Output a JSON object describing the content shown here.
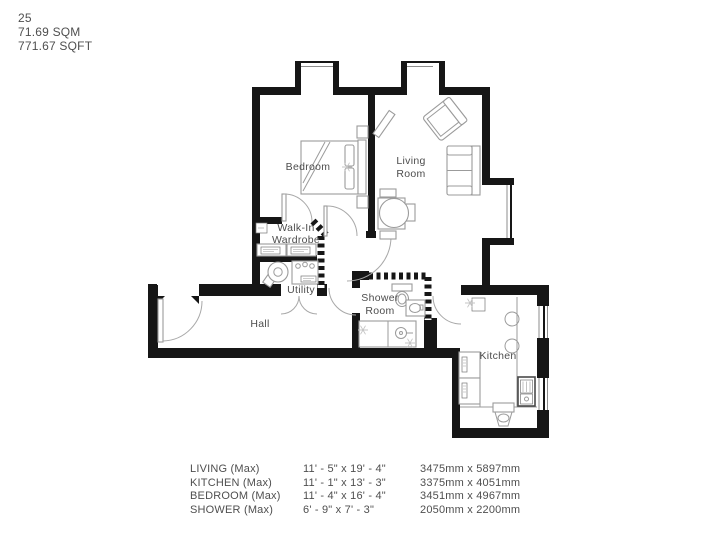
{
  "header": {
    "unit_number": "25",
    "area_sqm": "71.69 SQM",
    "area_sqft": "771.67 SQFT"
  },
  "floorplan": {
    "rooms": {
      "bedroom": "Bedroom",
      "living_line1": "Living",
      "living_line2": "Room",
      "wardrobe_line1": "Walk-In",
      "wardrobe_line2": "Wardrobe",
      "utility": "Utility",
      "hall": "Hall",
      "shower_line1": "Shower",
      "shower_line2": "Room",
      "kitchen": "Kitchen"
    }
  },
  "dimensions": {
    "rows": [
      {
        "room": "LIVING (Max)",
        "imperial": "11' - 5\" x 19' - 4\"",
        "metric": "3475mm x 5897mm"
      },
      {
        "room": "KITCHEN (Max)",
        "imperial": "11' - 1\" x 13' - 3\"",
        "metric": "3375mm x 4051mm"
      },
      {
        "room": "BEDROOM (Max)",
        "imperial": "11' - 4\" x 16' - 4\"",
        "metric": "3451mm x 4967mm"
      },
      {
        "room": "SHOWER (Max)",
        "imperial": "6' - 9\" x 7' - 3\"",
        "metric": "2050mm x 2200mm"
      }
    ]
  },
  "colors": {
    "wall": "#161616",
    "furniture_line": "#9b9b9b",
    "text": "#4f4f4f"
  }
}
